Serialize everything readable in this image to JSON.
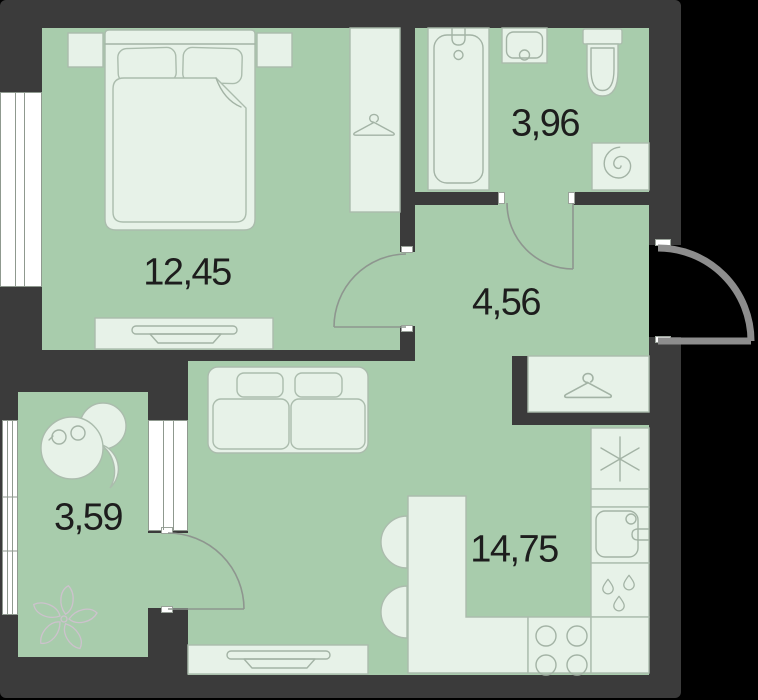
{
  "rooms": [
    {
      "id": "bedroom",
      "area_label": "12,45"
    },
    {
      "id": "bathroom",
      "area_label": "3,96"
    },
    {
      "id": "hallway",
      "area_label": "4,56"
    },
    {
      "id": "kitchen_living_room",
      "area_label": "14,75"
    },
    {
      "id": "balcony",
      "area_label": "3,59"
    }
  ],
  "colors": {
    "background": "#000000",
    "walls": "#3b3b3b",
    "room_fill": "#a8ccac",
    "furniture_fill": "#e7f2e8",
    "furniture_stroke": "#abbcad",
    "door_arc": "#8e968f",
    "entrance_door": "#8d8d8d",
    "window_fill": "#ffffff",
    "decor_stroke": "#cdc2cd",
    "label_text": "#1d1d1d"
  },
  "icons": [
    "double-bed-icon",
    "pillow-icon",
    "blanket-icon",
    "nightstand-icon",
    "wardrobe-hanger-icon",
    "dresser-tv-icon",
    "bathtub-icon",
    "washbasin-icon",
    "toilet-icon",
    "washing-machine-icon",
    "coat-closet-hanger-icon",
    "sofa-icon",
    "tv-console-icon",
    "fridge-snowflake-icon",
    "kitchen-sink-icon",
    "water-drops-icon",
    "stove-burners-icon",
    "bar-counter-icon",
    "bar-stool-icon",
    "balcony-table-chairs-icon",
    "flower-decor-icon",
    "door-swing-icon",
    "entrance-door-icon",
    "window-icon"
  ]
}
